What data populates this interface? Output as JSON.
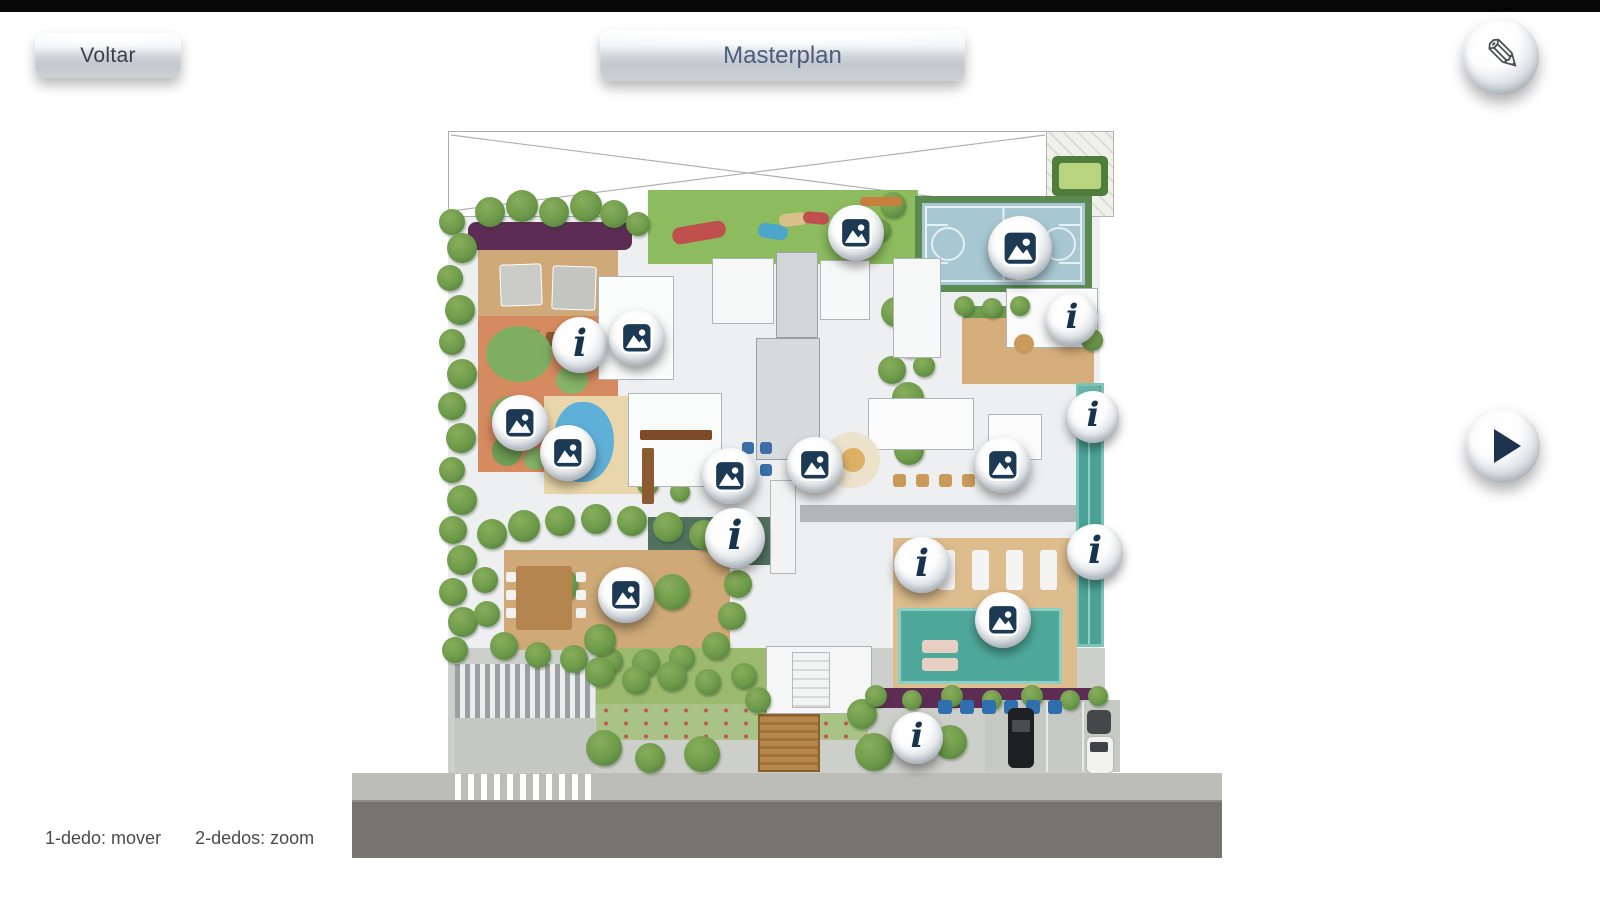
{
  "header": {
    "back_label": "Voltar",
    "title": "Masterplan"
  },
  "icons": {
    "edit": "pencil-icon",
    "edit_glyph": "✎",
    "play": "play-icon"
  },
  "hints": {
    "pan": "1-dedo: mover",
    "zoom": "2-dedos: zoom"
  },
  "colors": {
    "accent_navy": "#1d3552",
    "button_face": "#c9ced3",
    "court_floor": "#a7c8d2",
    "court_frame": "#5a8a50",
    "pool_teal": "#4fa99b",
    "lawn_green": "#8cbc5e",
    "deck_wood": "#cfa977",
    "hedge_purple": "#5c2c54",
    "road_gray": "#75756d",
    "sidewalk_gray": "#bdbdb7",
    "playground_terracotta": "#d68a5f"
  },
  "masterplan": {
    "markers": [
      {
        "id": "photo-play-lawn",
        "type": "photo",
        "x": 856,
        "y": 233,
        "size": 56
      },
      {
        "id": "photo-sports-court",
        "type": "photo",
        "x": 1020,
        "y": 248,
        "size": 64
      },
      {
        "id": "info-toys-room",
        "type": "info",
        "x": 580,
        "y": 345,
        "size": 56
      },
      {
        "id": "photo-reading-room",
        "type": "photo",
        "x": 637,
        "y": 338,
        "size": 56
      },
      {
        "id": "photo-playground",
        "type": "photo",
        "x": 520,
        "y": 423,
        "size": 56
      },
      {
        "id": "photo-kids-pool",
        "type": "photo",
        "x": 568,
        "y": 453,
        "size": 56
      },
      {
        "id": "photo-lounge-west",
        "type": "photo",
        "x": 730,
        "y": 476,
        "size": 56
      },
      {
        "id": "photo-lounge-east",
        "type": "photo",
        "x": 815,
        "y": 465,
        "size": 56
      },
      {
        "id": "photo-bar",
        "type": "photo",
        "x": 1003,
        "y": 465,
        "size": 56
      },
      {
        "id": "info-court-room",
        "type": "info",
        "x": 1072,
        "y": 319,
        "size": 52
      },
      {
        "id": "info-lap-pool-top",
        "type": "info",
        "x": 1093,
        "y": 417,
        "size": 52
      },
      {
        "id": "info-lap-pool-mid",
        "type": "info",
        "x": 1095,
        "y": 552,
        "size": 56
      },
      {
        "id": "info-pool-deck",
        "type": "info",
        "x": 922,
        "y": 565,
        "size": 56
      },
      {
        "id": "photo-main-pool",
        "type": "photo",
        "x": 1003,
        "y": 620,
        "size": 56
      },
      {
        "id": "photo-bbq-deck",
        "type": "photo",
        "x": 626,
        "y": 595,
        "size": 56
      },
      {
        "id": "info-central-patio",
        "type": "info",
        "x": 735,
        "y": 538,
        "size": 60
      },
      {
        "id": "info-entrance",
        "type": "info",
        "x": 917,
        "y": 738,
        "size": 52
      }
    ]
  }
}
